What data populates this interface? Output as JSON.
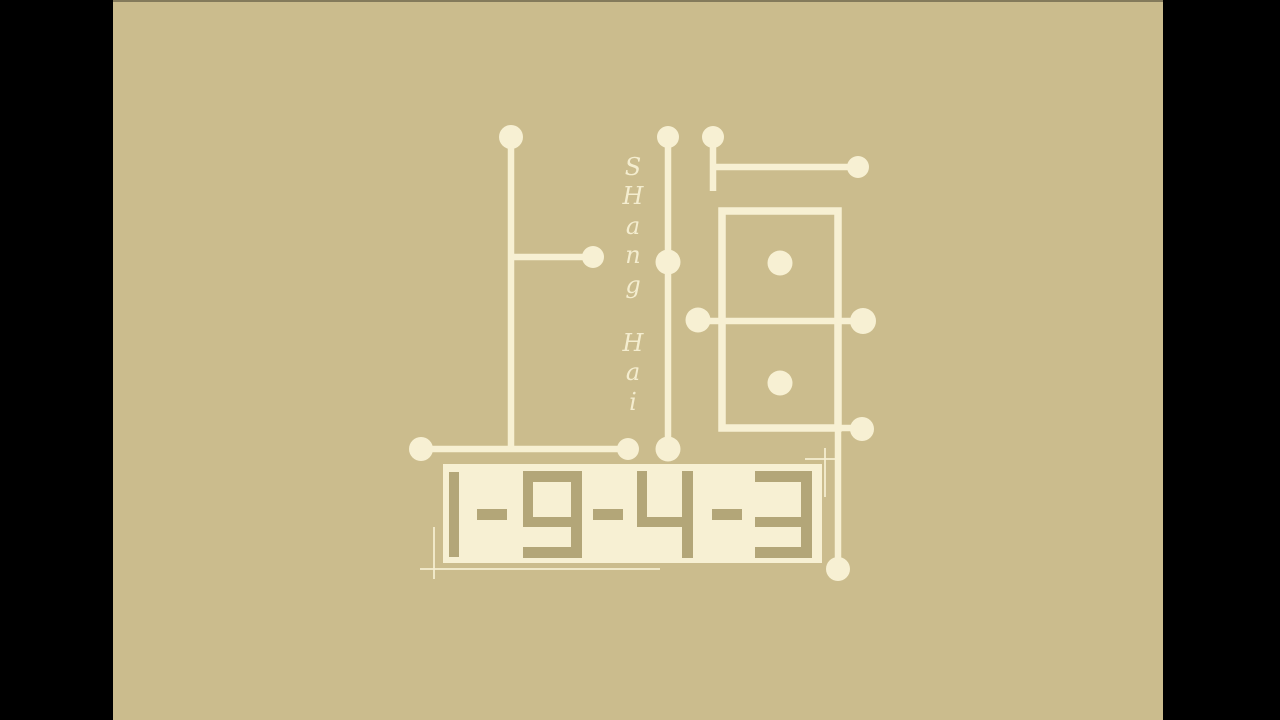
{
  "vertical_title": {
    "top_letters": [
      "S",
      "H",
      "a",
      "n",
      "g"
    ],
    "bottom_letters": [
      "H",
      "a",
      "i"
    ]
  },
  "year": {
    "display": "1-9-4-3"
  },
  "colors": {
    "letterbox": "#000000",
    "background": "#cbbc8d",
    "cream": "#f7f0d3",
    "digit": "#b3a678"
  }
}
